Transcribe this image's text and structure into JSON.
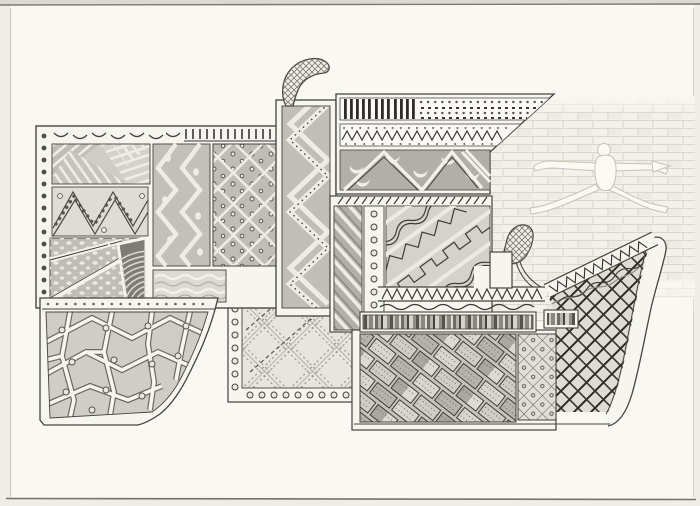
{
  "artwork": {
    "kind": "hand-drawn pencil-and-ink abstract composition",
    "description": "Interlocking patchwork blocks filled with folk-style patterns in graphite greys on cream paper; a faint brick wall with a white leaping-figure silhouette sits behind the right side.",
    "elements": [
      {
        "name": "left-panel-block",
        "patterns": [
          "striped straw patches",
          "zigzag with bead rows",
          "spotted field with white diagonal bands",
          "ribbed shell patch",
          "vertical chevron with dots",
          "diamond lattice with dots",
          "wavy water lines"
        ],
        "borders": [
          "bead column",
          "crescent row",
          "comb ticks"
        ]
      },
      {
        "name": "paving-panel",
        "pattern": "crazy paving polygons with single dots",
        "edge": "concave curved foot"
      },
      {
        "name": "plaid-panel",
        "pattern": "diagonal tartan of dashed lines",
        "borders": [
          "bead column",
          "bead row"
        ]
      },
      {
        "name": "chevron-column",
        "pattern": "bold white chevrons with dotted band",
        "top": "cross-hatched curved horn"
      },
      {
        "name": "cornice-block",
        "bands": [
          "vertical bars",
          "beadwork dot rows",
          "small zigzag with dots",
          "grey band with white crescents and triangle stripes"
        ],
        "shape": "slanted right end"
      },
      {
        "name": "center-block",
        "parts": [
          "tick row",
          "diagonal stripe strip",
          "bead strip",
          "diagonal motif field with step, wave and lightning bands"
        ]
      },
      {
        "name": "deck",
        "parts": [
          "sawtooth band",
          "wavy line",
          "barcode bar",
          "short barcode bar",
          "white chimney block"
        ]
      },
      {
        "name": "sled-block",
        "parts": [
          "slanted sawtooth band",
          "curved runner fin",
          "bold cross-hatch lattice",
          "cross-hatched feather plume"
        ]
      },
      {
        "name": "bottom-block",
        "parts": [
          "basket-weave of dashed bricks",
          "diamond grid with dots"
        ]
      },
      {
        "name": "brick-wall",
        "pattern": "faint running-bond bricks"
      },
      {
        "name": "leaping-figure",
        "pose": "straddle jump, arms spread, holding small leaf"
      }
    ]
  },
  "palette": {
    "paper": "#f9f8f3",
    "margin": "#e8e5dd",
    "frame": "#f6f5ef",
    "gap": "#eeede5",
    "ink": "#45433e",
    "inkDark": "#2e2c28",
    "tex": "#55534d",
    "g1": "#e0ded6",
    "g2": "#cfcdc5",
    "g3": "#bfbdb5",
    "g4": "#b1afa7",
    "g5": "#918f87",
    "g6": "#7e7c74",
    "brickLine": "#d9d6cb",
    "brickFill": "#f3f1ea",
    "figLine": "#c6c3b7",
    "figFill": "#faf9f4",
    "lattice": "#2c2a26"
  }
}
